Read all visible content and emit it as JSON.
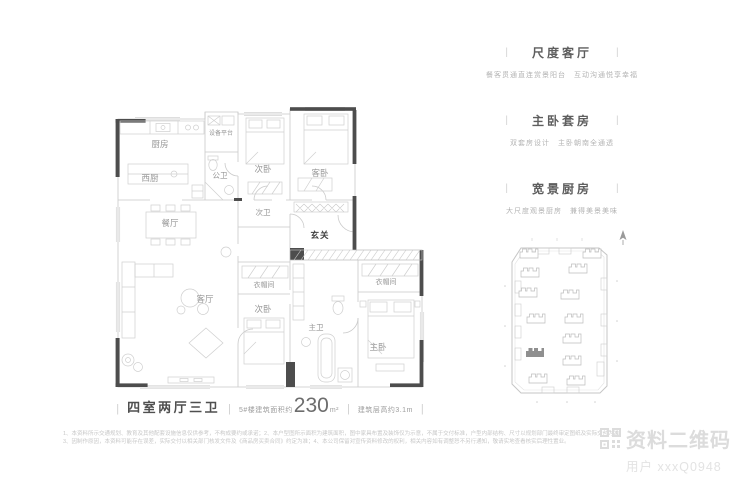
{
  "ui": {
    "pipe": "|"
  },
  "floorplan": {
    "rooms": [
      {
        "name": "厨房"
      },
      {
        "name": "西厨"
      },
      {
        "name": "设备平台"
      },
      {
        "name": "公卫"
      },
      {
        "name": "次卧"
      },
      {
        "name": "客卧"
      },
      {
        "name": "餐厅"
      },
      {
        "name": "次卫"
      },
      {
        "name": "玄关"
      },
      {
        "name": "衣帽间"
      },
      {
        "name": "客厅"
      },
      {
        "name": "次卧"
      },
      {
        "name": "衣帽间"
      },
      {
        "name": "主卫"
      },
      {
        "name": "主卧"
      }
    ]
  },
  "summary": {
    "layout": "四室两厅三卫",
    "area_label": "5#楼建筑面积约",
    "area_value": "230",
    "area_unit": "m²",
    "floor_height": "建筑层高约3.1m"
  },
  "highlights": [
    {
      "title": "尺度客厅",
      "desc": "餐客贯通直连赏景阳台　互动沟通悦享幸福"
    },
    {
      "title": "主卧套房",
      "desc": "双套房设计　主卧朝南全通透"
    },
    {
      "title": "宽景厨房",
      "desc": "大尺度观景厨房　兼得美景美味"
    }
  ],
  "disclaimer": {
    "line1": "1、本资料所示交通规划、教育及其他配套设施信息仅供参考，不构成要约或承诺；2、本户型图所示面积为建筑面积，图中家具布置及装饰仅为示意，不属于交付标准，户型内部结构、尺寸以规划部门最终审定图纸及实际交付为准；",
    "line2": "3、因制作原因，本资料可能存在误差，实际交付以相关部门核发文件及《商品房买卖合同》约定为准；4、本公司保留对宣传资料修改的权利，相关内容如有调整恕不另行通知，敬请实地查看核实后理性置业。"
  },
  "watermark": {
    "brand": "资料二维码",
    "user": "用户 xxxQ0948"
  }
}
